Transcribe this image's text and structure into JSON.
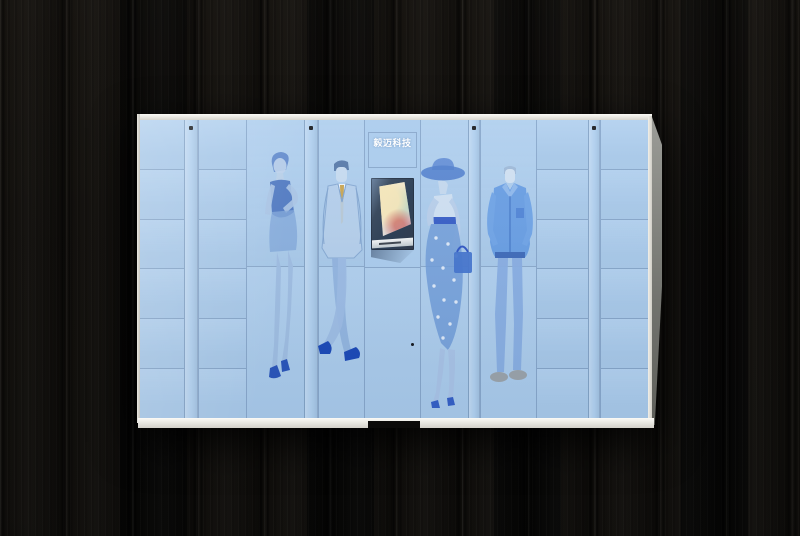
{
  "scene": {
    "description": "smart parcel locker cabinet photographed against a dark black wood-plank wall"
  },
  "colors": {
    "wall_base": "#0c0b09",
    "panel_blue": "#a9cbed",
    "seam_soft": "rgba(105,137,175,0.55)",
    "frame_white": "#f1efe8",
    "side_gray": "#8d8e89",
    "brand_text": "#ffffff",
    "recess_dark": "#243850",
    "screen_cream": "#f7efdc",
    "kick_notch": "#0b0a09",
    "figure_blue": "#4a7bcd"
  },
  "locker": {
    "brand_label": "毅迈科技",
    "columns": [
      {
        "id": "lockers-left-1",
        "type": "lockers",
        "width": 44,
        "rows": 6
      },
      {
        "id": "pillar-1",
        "type": "pillar",
        "width": 14,
        "dot": true
      },
      {
        "id": "lockers-left-2",
        "type": "lockers",
        "width": 48,
        "rows": 6
      },
      {
        "id": "door-woman-dress",
        "type": "door",
        "width": 58,
        "art": "woman-dress"
      },
      {
        "id": "pillar-2",
        "type": "pillar",
        "width": 14,
        "dot": true
      },
      {
        "id": "door-man-suit",
        "type": "door",
        "width": 46,
        "art": "man-suit"
      },
      {
        "id": "kiosk",
        "type": "kiosk",
        "width": 56
      },
      {
        "id": "door-woman-hat",
        "type": "door",
        "width": 48,
        "art": "woman-hat"
      },
      {
        "id": "pillar-3",
        "type": "pillar",
        "width": 12,
        "dot": true
      },
      {
        "id": "door-man-casual",
        "type": "door",
        "width": 56,
        "art": "man-casual"
      },
      {
        "id": "lockers-right-1",
        "type": "lockers",
        "width": 52,
        "rows": 6
      },
      {
        "id": "pillar-4",
        "type": "pillar",
        "width": 12,
        "dot": true
      },
      {
        "id": "lockers-right-2",
        "type": "lockers",
        "width": 48,
        "rows": 6
      }
    ],
    "artwork": [
      {
        "name": "woman-dress",
        "description": "sketched woman in sleeveless dress, hand on hip, high heels"
      },
      {
        "name": "man-suit",
        "description": "sketched man in light suit with tan tie, ankles crossed"
      },
      {
        "name": "woman-hat",
        "description": "sketched woman in wide-brim hat, polka-dot skirt, handbag"
      },
      {
        "name": "man-casual",
        "description": "sketched man in casual jacket and jeans"
      }
    ]
  }
}
